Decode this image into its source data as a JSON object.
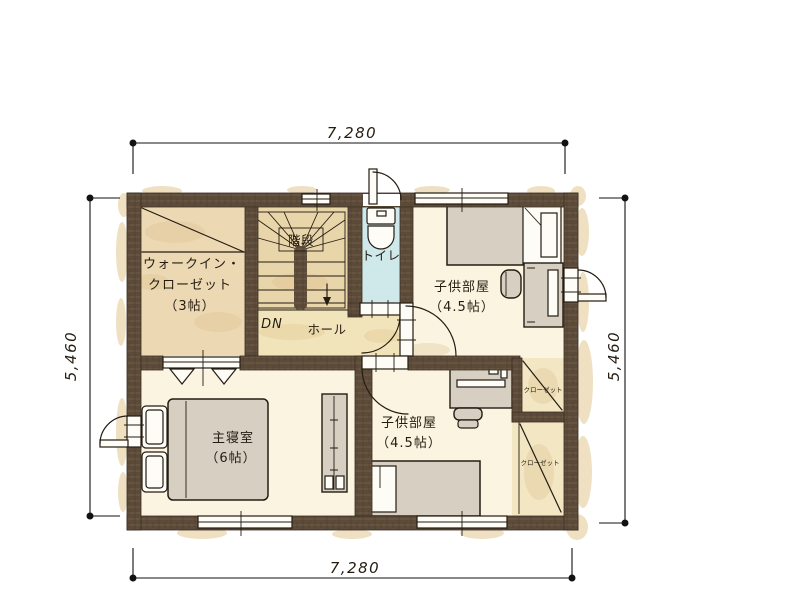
{
  "title": "2F floor plan",
  "palette": {
    "wall": "#5d4b3a",
    "wall_streak_light": "#7d6750",
    "wall_streak_dark": "#46362a",
    "floor_cream": "#fbf4e0",
    "floor_tan": "#ecd9b3",
    "floor_stairs": "#e9d5aa",
    "floor_hall": "#f2e4ba",
    "floor_toilet": "#cfe8ea",
    "floor_closet": "#f3e6c3",
    "furniture": "#d7d0c2",
    "splotch": "#e7d0a3",
    "patch": "#dcbd8b"
  },
  "dimensions": {
    "top": "7,280",
    "bottom": "7,280",
    "left": "5,460",
    "right": "5,460"
  },
  "rooms": {
    "wic": {
      "name_line1": "ウォークイン・",
      "name_line2": "クローゼット",
      "size": "（3帖）"
    },
    "stairs": {
      "label": "階段",
      "down": "DN"
    },
    "hall": {
      "label": "ホール"
    },
    "toilet": {
      "label": "トイレ"
    },
    "child1": {
      "label": "子供部屋",
      "size": "（4.5帖）"
    },
    "child2": {
      "label": "子供部屋",
      "size": "（4.5帖）"
    },
    "master": {
      "label": "主寝室",
      "size": "（6帖）"
    },
    "closet1": {
      "label": "クローゼット"
    },
    "closet2": {
      "label": "クローゼット"
    }
  }
}
